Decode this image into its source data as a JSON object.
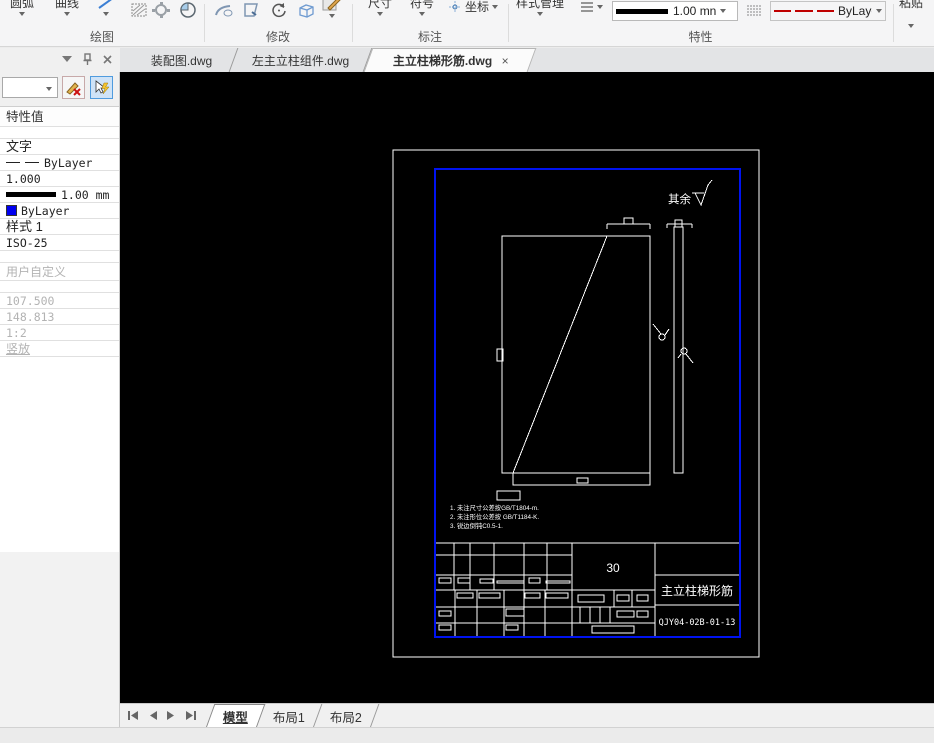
{
  "ribbon": {
    "groups": {
      "draw": "绘图",
      "modify": "修改",
      "annotate": "标注",
      "properties": "特性"
    },
    "buttons": {
      "arc": "圆弧",
      "curve": "曲线",
      "dimension": "尺寸",
      "symbol": "符号",
      "coordinate": "坐标",
      "style_manager": "样式管理",
      "paste": "粘贴"
    },
    "lineweight_combo": {
      "value": "1.00 mn"
    },
    "linetype_combo": {
      "value": "ByLayer"
    }
  },
  "doc_tabs": {
    "tabs": [
      {
        "label": "装配图.dwg"
      },
      {
        "label": "左主立柱组件.dwg"
      },
      {
        "label": "主立柱梯形筋.dwg"
      }
    ],
    "close_glyph": "×"
  },
  "sidebar": {
    "header": "特性值",
    "rows": [
      {
        "label": "文字"
      },
      {
        "label": "ByLayer"
      },
      {
        "label": "1.000"
      },
      {
        "label": "1.00 mm"
      },
      {
        "label": "ByLayer"
      },
      {
        "label": "样式 1"
      },
      {
        "label": "ISO-25"
      },
      {
        "label": "用户自定义"
      },
      {
        "label": "107.500"
      },
      {
        "label": "148.813"
      },
      {
        "label": "1:2"
      },
      {
        "label": "竖放"
      }
    ],
    "color_swatch": "#0000f0"
  },
  "drawing": {
    "surface_note": "其余",
    "notes": [
      "1. 未注尺寸公差按GB/T1804-m.",
      "2. 未注形位公差按 GB/T1184-K.",
      "3. 锐边倒钝C0.5-1."
    ],
    "title_block": {
      "material": "30",
      "part_name": "主立柱梯形筋",
      "drawing_no": "QJY04-02B-01-13"
    },
    "frame_color": "#0013f0",
    "line_color": "#ffffff"
  },
  "layout_tabs": {
    "tabs": [
      {
        "label": "模型"
      },
      {
        "label": "布局1"
      },
      {
        "label": "布局2"
      }
    ]
  }
}
